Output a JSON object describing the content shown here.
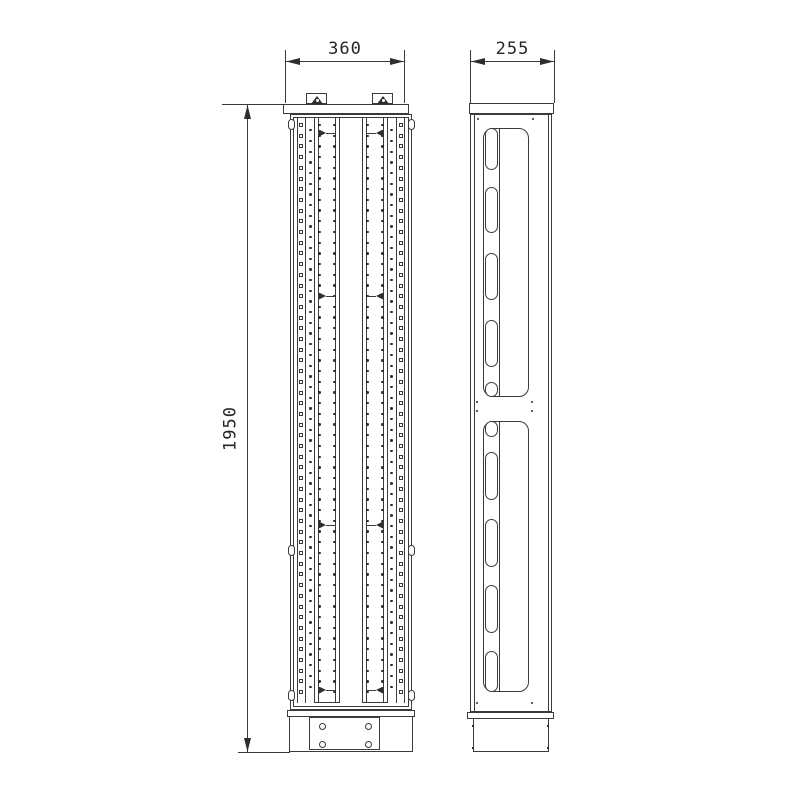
{
  "drawing": {
    "dimensions": {
      "front_width": "360",
      "side_depth": "255",
      "overall_height": "1950"
    },
    "colors": {
      "line": "#3b3b3b",
      "dark_fill": "#2e2e2e",
      "background": "#ffffff"
    }
  }
}
